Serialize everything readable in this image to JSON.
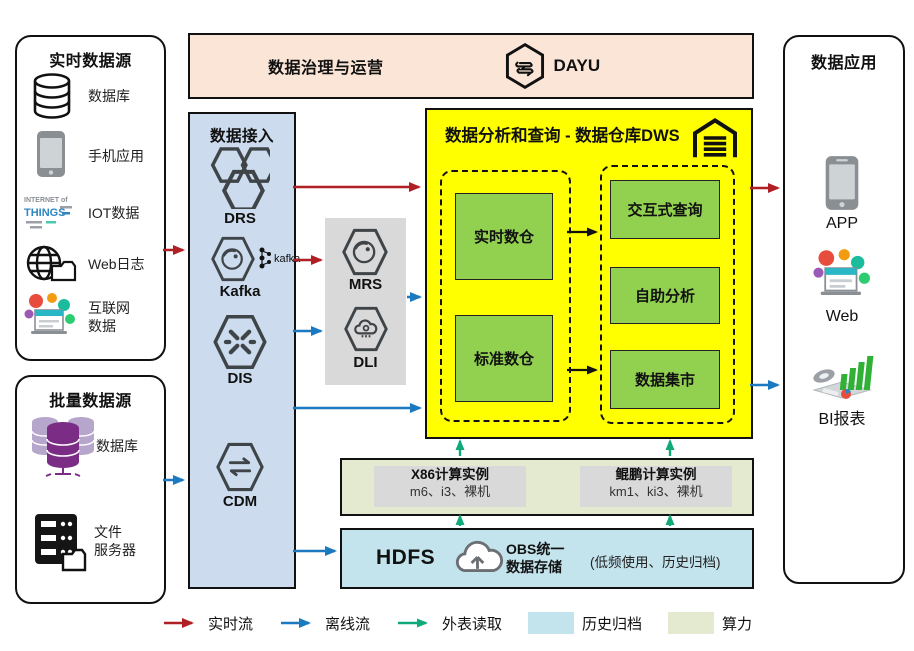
{
  "colors": {
    "realtime_flow": "#b01f24",
    "offline_flow": "#1b79c0",
    "external_read": "#0fa97a",
    "banner_fill": "#fbe5d6",
    "access_fill": "#ccdcee",
    "dws_fill": "#ffff00",
    "warehouse_fill": "#92d050",
    "gray_fill": "#d9d9d9",
    "compute_fill": "#e3ead0",
    "storage_fill": "#c3e3ed"
  },
  "realtime_sources": {
    "title": "实时数据源",
    "items": [
      {
        "label": "数据库"
      },
      {
        "label": "手机应用"
      },
      {
        "label": "IOT数据"
      },
      {
        "label": "Web日志"
      },
      {
        "label_line1": "互联网",
        "label_line2": "数据"
      }
    ]
  },
  "batch_sources": {
    "title": "批量数据源",
    "items": [
      {
        "label": "数据库"
      },
      {
        "label_line1": "文件",
        "label_line2": "服务器"
      }
    ]
  },
  "banner": {
    "title": "数据治理与运营",
    "product": "DAYU"
  },
  "access": {
    "title": "数据接入",
    "services": [
      {
        "name": "DRS"
      },
      {
        "name": "Kafka",
        "logo_text": "kafka"
      },
      {
        "name": "DIS"
      },
      {
        "name": "CDM"
      }
    ]
  },
  "cluster": {
    "services": [
      {
        "name": "MRS"
      },
      {
        "name": "DLI"
      }
    ]
  },
  "dws": {
    "title": "数据分析和查询 - 数据仓库DWS",
    "left_units": [
      {
        "label": "实时数仓"
      },
      {
        "label": "标准数仓"
      }
    ],
    "right_units": [
      {
        "label": "交互式查询"
      },
      {
        "label": "自助分析"
      },
      {
        "label": "数据集市"
      }
    ]
  },
  "compute": {
    "x86": {
      "title": "X86计算实例",
      "models": "m6、i3、裸机"
    },
    "kunpeng": {
      "title": "鲲鹏计算实例",
      "models": "km1、ki3、裸机"
    }
  },
  "storage": {
    "hdfs": "HDFS",
    "obs_line1": "OBS统一",
    "obs_line2": "数据存储",
    "note": "(低频使用、历史归档)"
  },
  "apps": {
    "title": "数据应用",
    "items": [
      {
        "label": "APP"
      },
      {
        "label": "Web"
      },
      {
        "label": "BI报表"
      }
    ]
  },
  "legend": {
    "realtime": "实时流",
    "offline": "离线流",
    "external": "外表读取",
    "archive": "历史归档",
    "compute": "算力"
  },
  "iot_icon_words": {
    "top": "INTERNET of",
    "bottom": "THINGS"
  }
}
